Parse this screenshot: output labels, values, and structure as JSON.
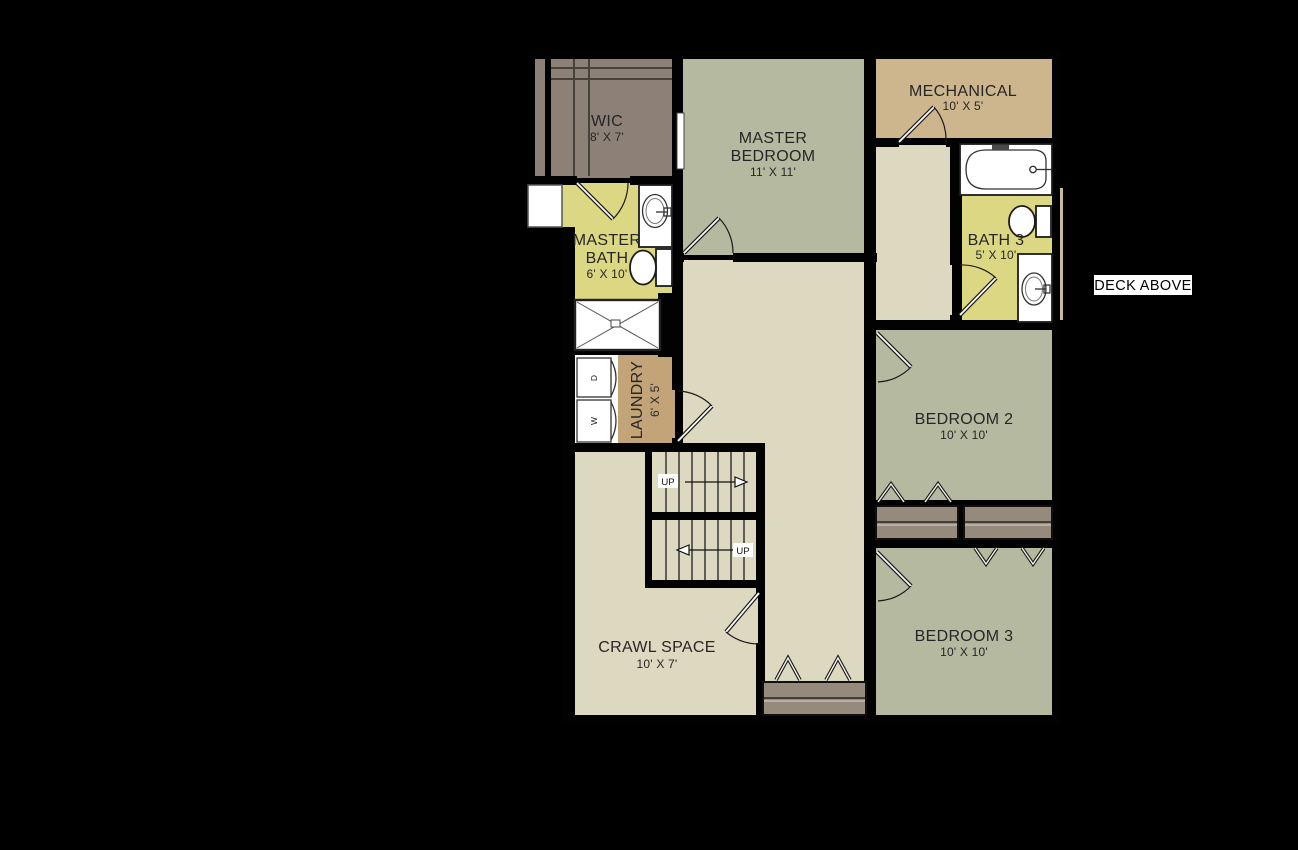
{
  "colors": {
    "background": "#000000",
    "wall": "#020202",
    "wic_fill": "#8d8076",
    "bedroom_fill": "#b4b9a0",
    "mech_fill": "#cdb68d",
    "bath_fill": "#dcd782",
    "hall_fill": "#ddd8c0",
    "laundry_fill": "#c2a478",
    "closet_fill": "#958a7c",
    "deck_strip": "#c9ba94",
    "label_text": "#262626",
    "fixture_white": "#ffffff",
    "deck_label_bg": "#ffffff"
  },
  "labels": {
    "wic": {
      "name": "WIC",
      "dims": "8' X 7'"
    },
    "master_bedroom": {
      "line1": "MASTER",
      "line2": "BEDROOM",
      "dims": "11' X 11'"
    },
    "mechanical": {
      "name": "MECHANICAL",
      "dims": "10' X 5'"
    },
    "bath3": {
      "name": "BATH 3",
      "dims": "5' X 10'"
    },
    "master_bath": {
      "line1": "MASTER",
      "line2": "BATH",
      "dims": "6' X 10'"
    },
    "laundry": {
      "name": "LAUNDRY",
      "dims": "6' X 5'"
    },
    "crawl_space": {
      "name": "CRAWL SPACE",
      "dims": "10' X 7'"
    },
    "bedroom2": {
      "name": "BEDROOM 2",
      "dims": "10' X 10'"
    },
    "bedroom3": {
      "name": "BEDROOM 3",
      "dims": "10' X 10'"
    },
    "deck": {
      "name": "DECK ABOVE"
    },
    "stairs": {
      "up_upper": "UP",
      "up_lower": "UP"
    },
    "machines": {
      "washer": "W",
      "dryer": "D"
    }
  },
  "icons": [
    "bathtub-icon",
    "toilet-icon",
    "sink-icon",
    "shower-icon",
    "washer-icon",
    "dryer-icon",
    "door-swing-icon",
    "stairs-up-icon",
    "bifold-door-icon",
    "window-icon",
    "closet-shelf-icon"
  ]
}
